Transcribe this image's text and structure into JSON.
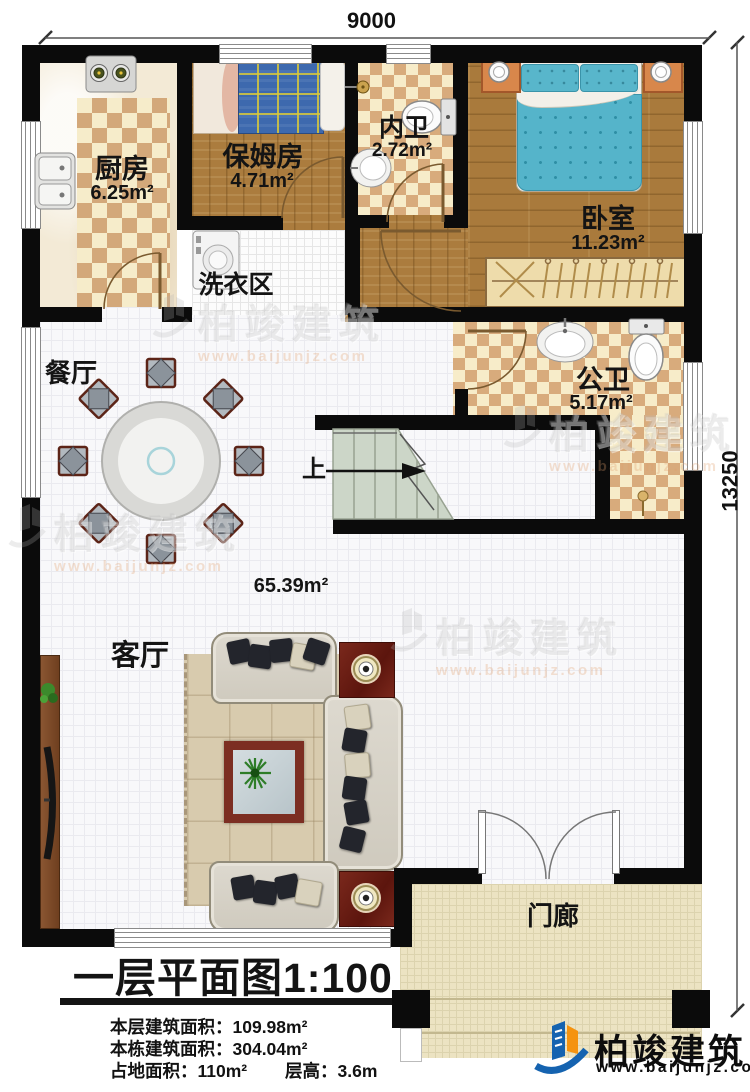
{
  "page": {
    "title": "一层平面图1:100"
  },
  "dimensions": {
    "width_mm": "9000",
    "height_mm": "13250"
  },
  "rooms": {
    "kitchen": {
      "label": "厨房",
      "area": "6.25m²"
    },
    "nanny": {
      "label": "保姆房",
      "area": "4.71m²"
    },
    "inner_bath": {
      "label": "内卫",
      "area": "2.72m²"
    },
    "bedroom": {
      "label": "卧室",
      "area": "11.23m²"
    },
    "laundry": {
      "label": "洗衣区"
    },
    "dining": {
      "label": "餐厅"
    },
    "public_bath": {
      "label": "公卫",
      "area": "5.17m²"
    },
    "living": {
      "label": "客厅",
      "area": "65.39m²"
    },
    "porch": {
      "label": "门廊"
    },
    "stairs": {
      "label": "上"
    }
  },
  "stats": {
    "floor_area_label": "本层建筑面积：",
    "floor_area_value": "109.98m²",
    "total_area_label": "本栋建筑面积：",
    "total_area_value": "304.04m²",
    "footprint_label": "占地面积：",
    "footprint_value": "110m²",
    "height_label": "层高：",
    "height_value": "3.6m"
  },
  "brand": {
    "name": "柏竣建筑",
    "url": "www.baijunjz.com"
  },
  "colors": {
    "wall": "#0b0b0b",
    "wood": "#ab7c3e",
    "tile_tan": "#d8ab7c",
    "bed_teal": "#55b4ca",
    "nanny_bed_blue": "#3d69ae",
    "stairs_green": "#ccd6c8",
    "porch_beige": "#ece3c2",
    "logo_blue": "#1563b0",
    "logo_orange": "#f5930f"
  }
}
